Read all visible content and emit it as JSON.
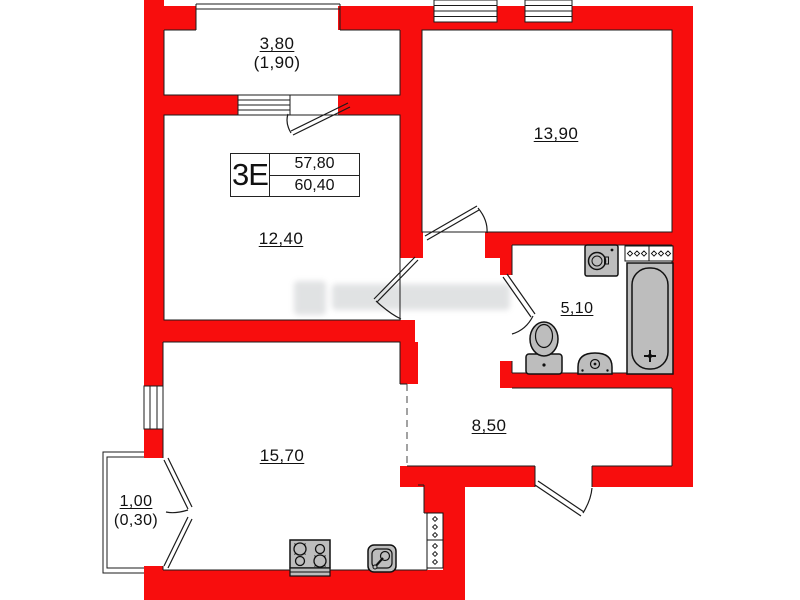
{
  "plan": {
    "title": "apartment floor plan",
    "unit": {
      "label": "3Е",
      "value_top": "57,80",
      "value_bottom": "60,40"
    },
    "rooms": {
      "balcony_top": {
        "area": "3,80",
        "area_reduced": "(1,90)"
      },
      "bedroom": {
        "area": "13,90"
      },
      "living_room": {
        "area": "12,40"
      },
      "bathroom": {
        "area": "5,10"
      },
      "hallway": {
        "area": "8,50"
      },
      "kitchen_living": {
        "area": "15,70"
      },
      "balcony_bottom": {
        "area": "1,00",
        "area_reduced": "(0,30)"
      }
    },
    "fixtures": [
      "washing-machine-icon",
      "bathtub-icon",
      "toilet-icon",
      "bath-sink-icon",
      "vent-grille-icon",
      "kitchen-vent-icon",
      "stove-icon",
      "kitchen-sink-icon"
    ],
    "colors": {
      "wall": "#f80d0d",
      "fixture": "#bdbdbd",
      "line": "#1b1b1b"
    }
  }
}
